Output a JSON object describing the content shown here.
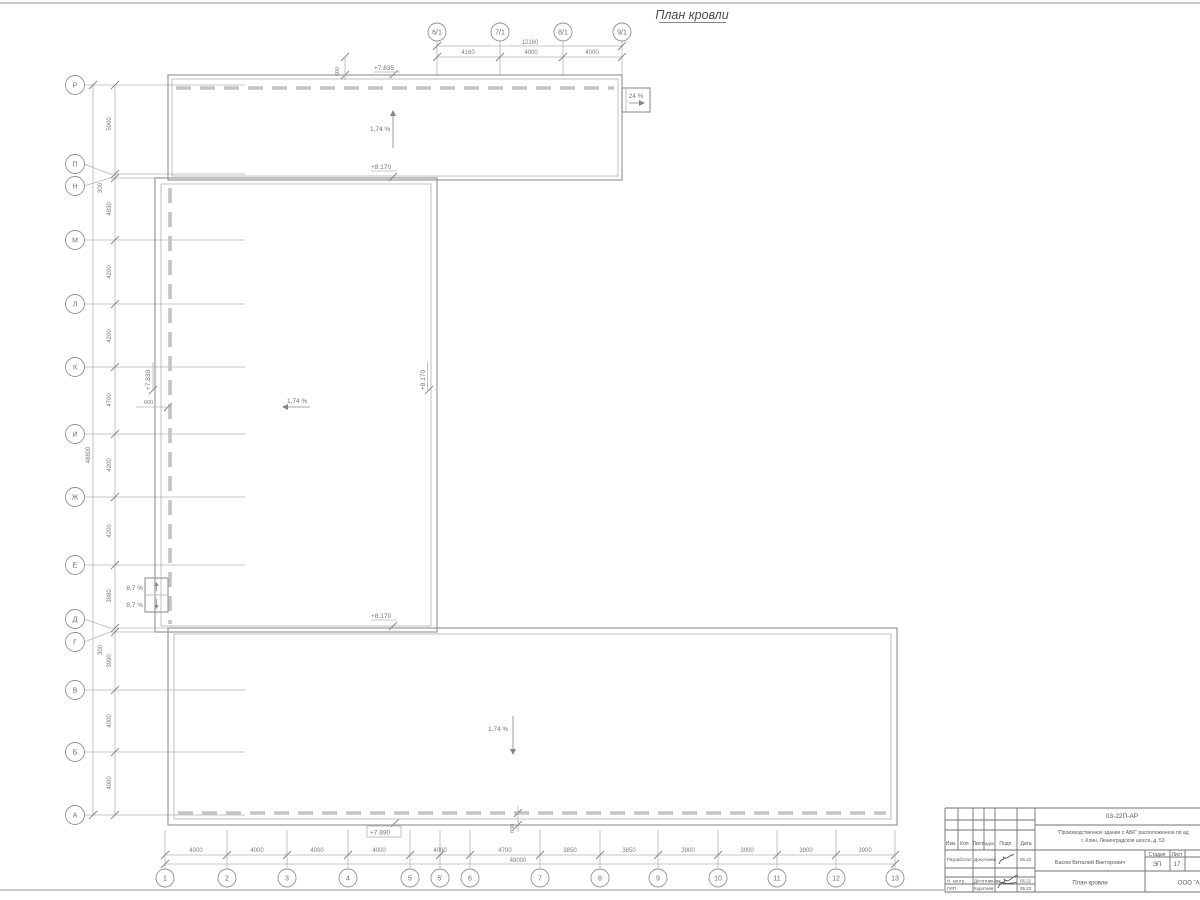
{
  "sheet": {
    "title": "План кровли"
  },
  "axes": {
    "top": {
      "markers": [
        "6/1",
        "7/1",
        "8/1",
        "9/1"
      ],
      "dims": [
        "4160",
        "4000",
        "4000"
      ],
      "total": "12160"
    },
    "left": {
      "markers": [
        "Р",
        "П",
        "Н",
        "М",
        "Л",
        "К",
        "И",
        "Ж",
        "Е",
        "Д",
        "Г",
        "В",
        "Б",
        "А"
      ],
      "dims": [
        "5900",
        "300",
        "4830",
        "4200",
        "4200",
        "4700",
        "4200",
        "4200",
        "3980",
        "300",
        "3990",
        "4000",
        "4000"
      ],
      "total": "48800"
    },
    "bottom": {
      "markers": [
        "1",
        "2",
        "3",
        "4",
        "5",
        "5'",
        "6",
        "7",
        "8",
        "9",
        "10",
        "11",
        "12",
        "13"
      ],
      "dims": [
        "4000",
        "4000",
        "4000",
        "4000",
        "4000",
        "4700",
        "3850",
        "3850",
        "3900",
        "3900",
        "3900",
        "3900"
      ],
      "total": "48000"
    }
  },
  "levels": {
    "top_upper": "+7.835",
    "top_lower": "+8.170",
    "mid_left": "+7.830",
    "mid_right": "+8.170",
    "mid_lower": "+8.170",
    "bottom": "+7.890"
  },
  "slopes": {
    "roof": "1,74 %",
    "ramp": "24 %",
    "ladder": "8,7 %"
  },
  "small_dims": {
    "parapet": "600"
  },
  "title_block": {
    "doc_number": "03-22П-АР",
    "project_name": "\"Производственное здание с АБК\" расположенное по ад",
    "project_address": "г. Клин, Ленинградское шоссе, д. 53",
    "col_headers": [
      "Изм.",
      "Кол.",
      "Лист",
      "№док.",
      "Подп.",
      "Дата"
    ],
    "roles": [
      {
        "role": "Разработал",
        "name": "Докучаева",
        "date": "05.22"
      },
      {
        "role": "Н. контр.",
        "name": "Десятникова",
        "date": "05.22"
      },
      {
        "role": "ГИП",
        "name": "Коротаев",
        "date": "05.22"
      }
    ],
    "chief_name": "Басюк Виталий Викторович",
    "stage_label": "Стадия",
    "sheet_label": "Лист",
    "stage_value": "ЭП",
    "sheet_value": "17",
    "drawing_title": "План кровли",
    "company": "ООО \"Аль"
  }
}
